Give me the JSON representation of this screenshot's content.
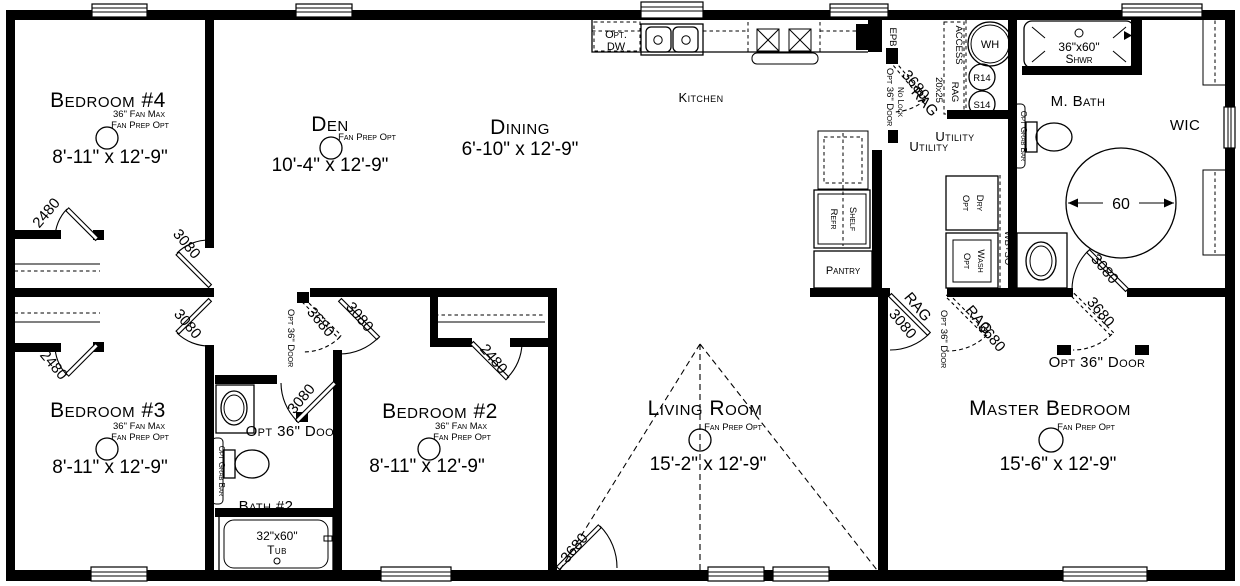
{
  "plan": {
    "rooms": {
      "bedroom4": {
        "name": "Bedroom #4",
        "note1": "36\" Fan Max",
        "note2": "Fan Prep Opt",
        "dims": "8'-11\" x 12'-9\""
      },
      "den": {
        "name": "Den",
        "note2": "Fan Prep Opt",
        "dims": "10'-4\" x 12'-9\""
      },
      "dining": {
        "name": "Dining",
        "dims": "6'-10\" x 12'-9\""
      },
      "kitchen": {
        "name": "Kitchen"
      },
      "utility": {
        "name": "Utility"
      },
      "mbath": {
        "name": "M. Bath"
      },
      "wic": {
        "name": "WIC"
      },
      "master": {
        "name": "Master Bedroom",
        "note2": "Fan Prep Opt",
        "dims": "15'-6\" x 12'-9\""
      },
      "living": {
        "name": "Living Room",
        "note2": "Fan Prep Opt",
        "dims": "15'-2\" x 12'-9\""
      },
      "bedroom3": {
        "name": "Bedroom #3",
        "note1": "36\" Fan Max",
        "note2": "Fan Prep Opt",
        "dims": "8'-11\" x 12'-9\""
      },
      "bedroom2": {
        "name": "Bedroom #2",
        "note1": "36\" Fan Max",
        "note2": "Fan Prep Opt",
        "dims": "8'-11\" x 12'-9\""
      },
      "bath2": {
        "name": "Bath #2"
      }
    },
    "fixtures": {
      "opt_dw1": "Opt.",
      "opt_dw2": "DW",
      "shower_size": "36\"x60\"",
      "shower": "Shwr",
      "tub_size": "32\"x60\"",
      "tub": "Tub",
      "wh": "WH",
      "r14": "R14",
      "s14": "S14",
      "epb": "EPB",
      "access": "ACCESS",
      "rag": "RAG",
      "attic": "20x25",
      "no_lock": "No Lock",
      "opt": "Opt",
      "dry": "Dry",
      "wash": "Wash",
      "wbso": "WB+SO",
      "refr": "Refr",
      "shelf": "Shelf",
      "pantry": "Pantry",
      "grab": "Opt Grab Bar",
      "turn": "60"
    },
    "doors": {
      "d2480": "2480",
      "d3080": "3080",
      "d3680": "3680",
      "opt36": "Opt 36\" Door"
    }
  }
}
